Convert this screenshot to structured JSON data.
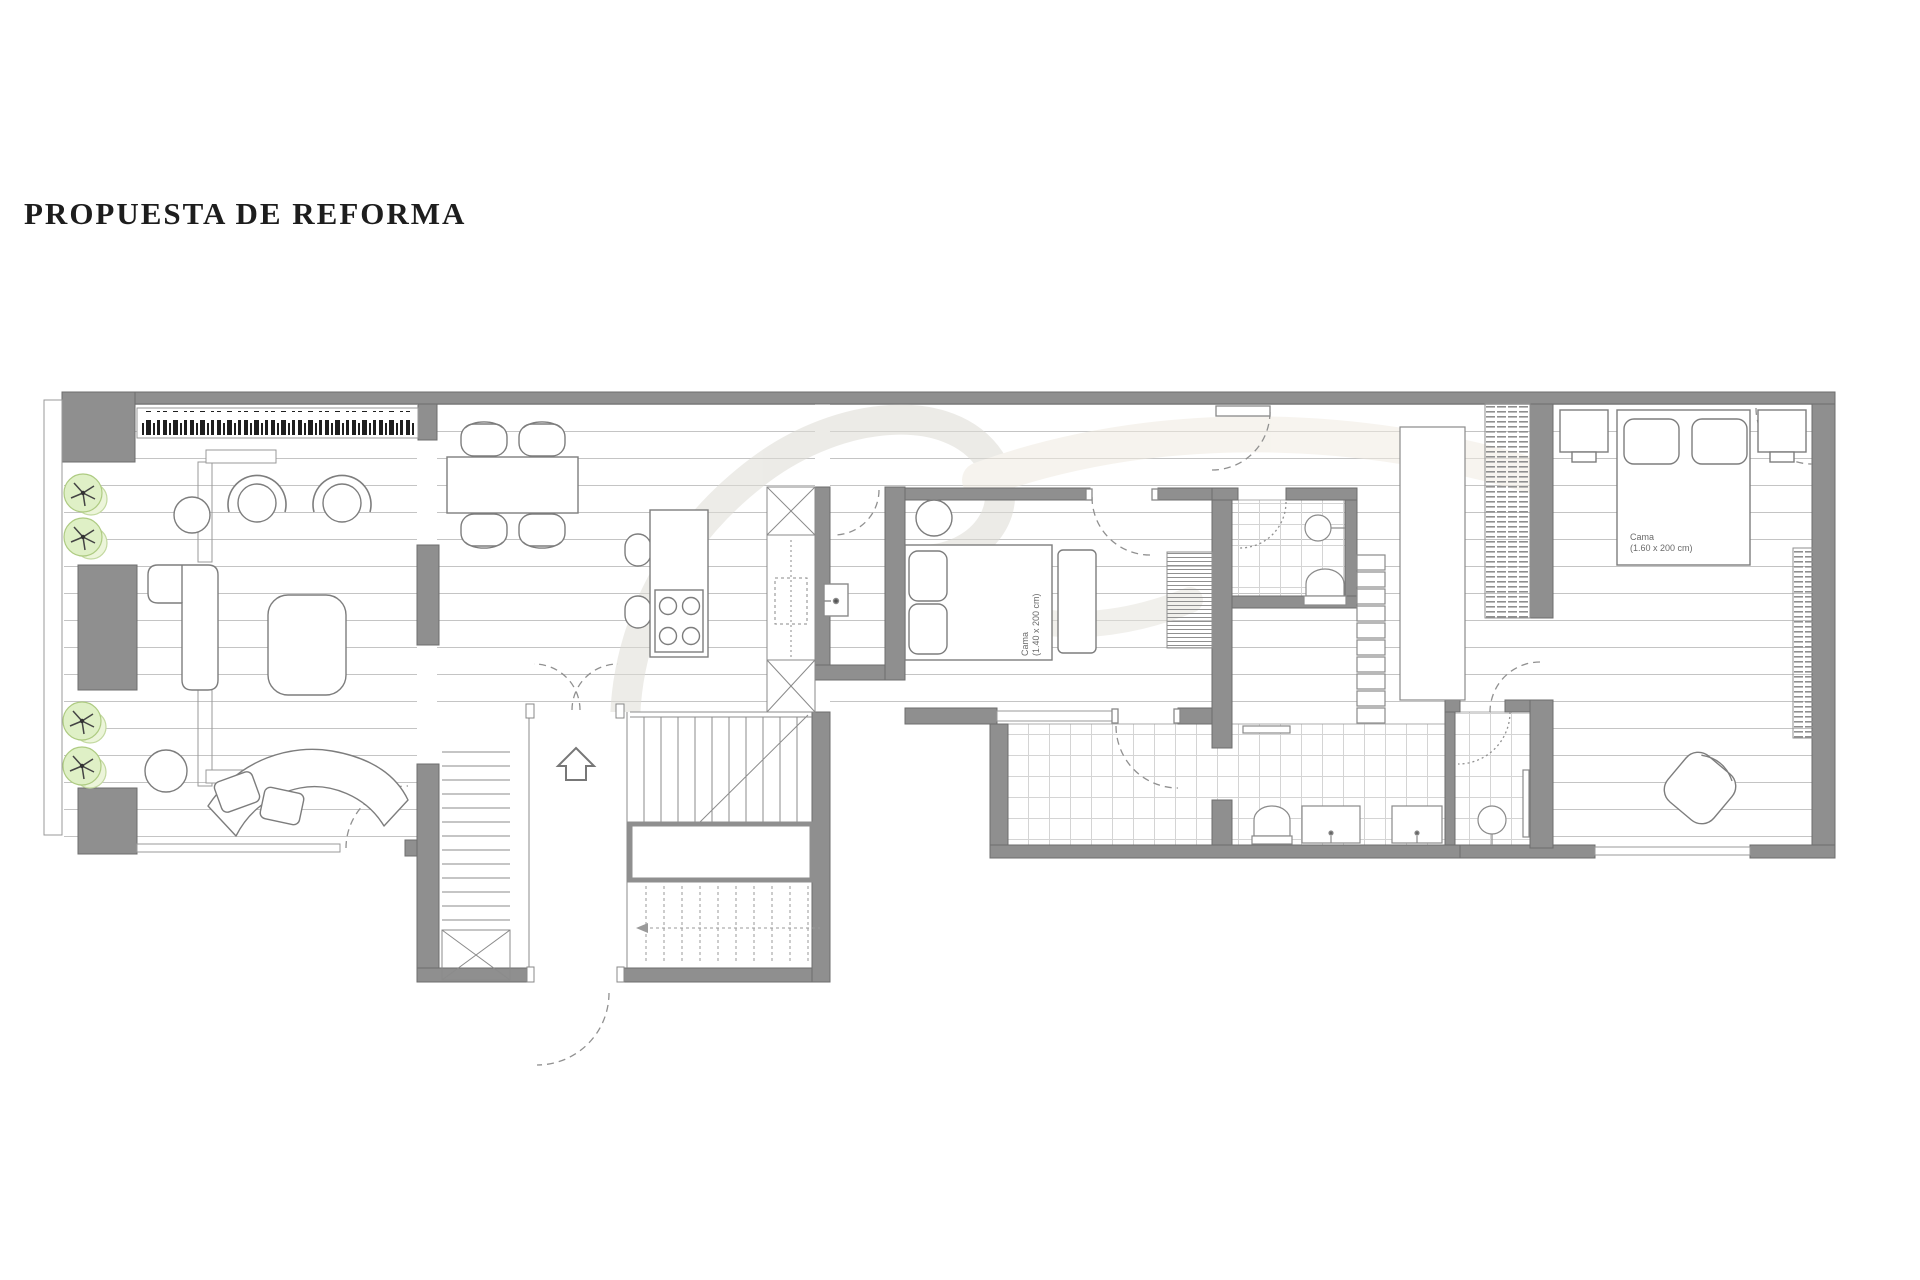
{
  "title": "PROPUESTA DE REFORMA",
  "annotations": {
    "bed1": {
      "line1": "Cama",
      "line2": "(1.40 x 200 cm)"
    },
    "bed2": {
      "line1": "Cama",
      "line2": "(1.60 x 200 cm)"
    }
  },
  "icons": {
    "entry_arrow": "up-arrow-icon",
    "plants": "plant-icon",
    "cooktop": "four-burner-cooktop-icon",
    "shower": "shower-drain-icon"
  },
  "colors": {
    "wall": "#8f8f8f",
    "wall_stroke": "#6d6d6d",
    "floor_line": "#c4c4c4",
    "tile_line": "#d4d4d4",
    "furniture_stroke": "#7d7d7d",
    "fixture_stroke": "#8a8a8a",
    "plant_fill": "#dff0c6",
    "plant_stroke": "#aecb82",
    "door_arc": "#909090",
    "radiator_keys": "#1f1f1f",
    "title_color": "#1d1d1d",
    "label_color": "#6a6a6a",
    "watermark_gray": "#dedcd5",
    "watermark_beige": "#f0ebe1"
  }
}
